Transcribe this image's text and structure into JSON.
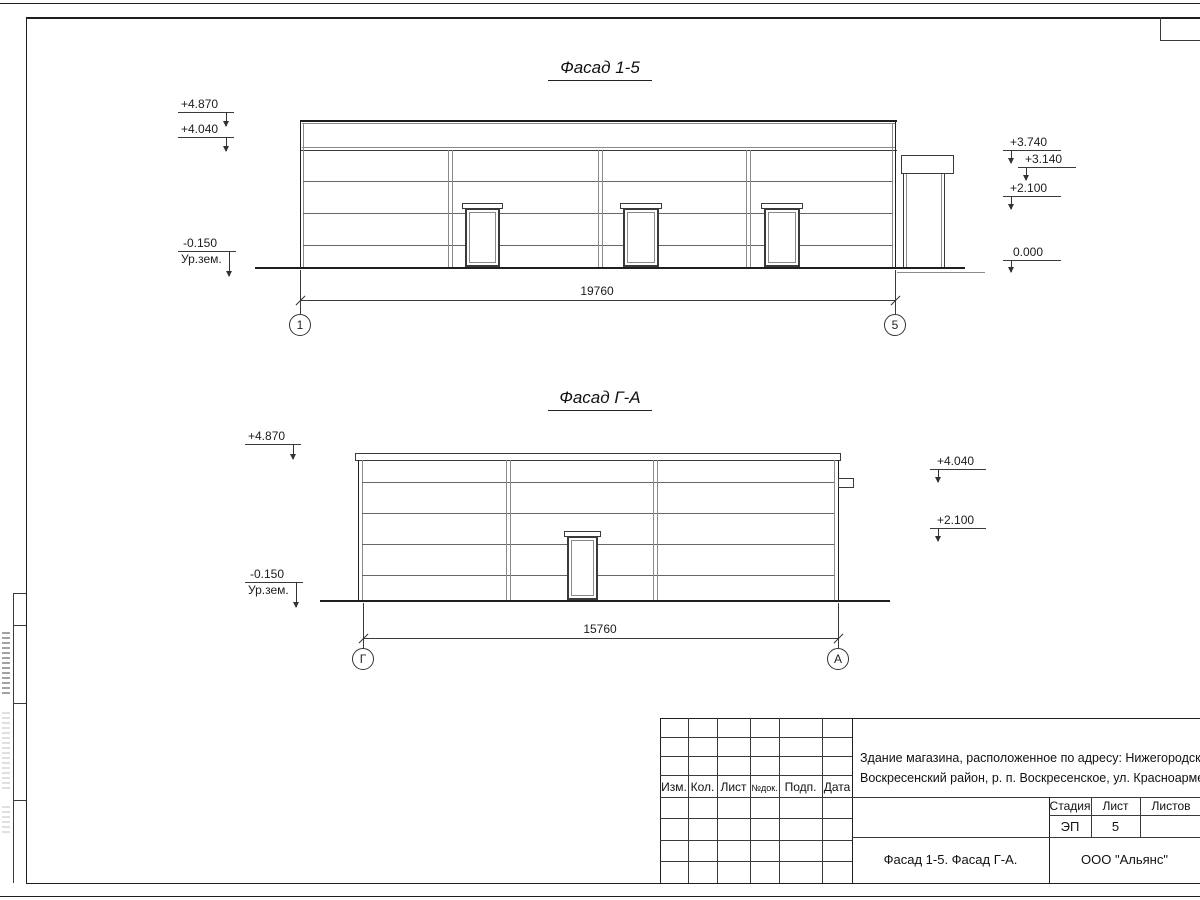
{
  "colors": {
    "ink": "#333333",
    "paper": "#ffffff"
  },
  "facade1": {
    "title": "Фасад 1-5",
    "elevations_left": [
      "+4.870",
      "+4.040",
      "-0.150"
    ],
    "ground_label": "Ур.зем.",
    "elevations_right": [
      "+3.740",
      "+3.140",
      "+2.100",
      "0.000"
    ],
    "dimension": "19760",
    "axis_left": "1",
    "axis_right": "5"
  },
  "facade2": {
    "title": "Фасад Г-А",
    "elevations_left": [
      "+4.870",
      "-0.150"
    ],
    "ground_label": "Ур.зем.",
    "elevations_right": [
      "+4.040",
      "+2.100"
    ],
    "dimension": "15760",
    "axis_left": "Г",
    "axis_right": "А"
  },
  "title_block": {
    "revision_columns": [
      "Изм.",
      "Кол.",
      "Лист",
      "№док.",
      "Подп.",
      "Дата"
    ],
    "project_address_line1": "Здание магазина, расположенное по адресу: Нижегородская область",
    "project_address_line2": "Воскресенский район, р. п. Воскресенское, ул. Красноармейская, д. 1",
    "stage_header": "Стадия",
    "sheet_header": "Лист",
    "sheets_header": "Листов",
    "stage_value": "ЭП",
    "sheet_value": "5",
    "sheet_name": "Фасад 1-5. Фасад Г-А.",
    "organization": "ООО \"Альянс\""
  }
}
